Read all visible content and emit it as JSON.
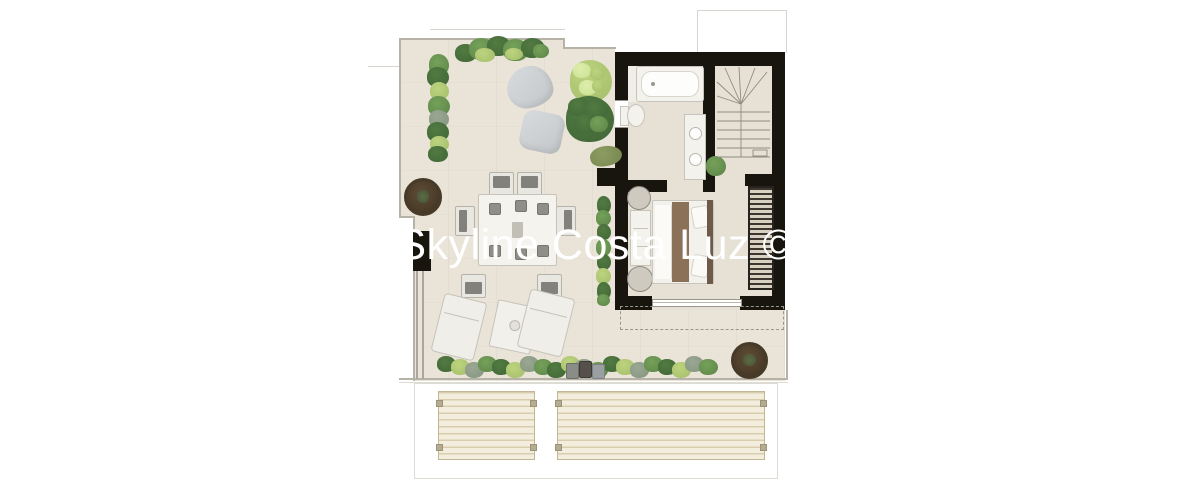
{
  "watermark": {
    "text": "Skyline Costa Luz ©",
    "color": "#ffffff"
  },
  "page": {
    "background": "#ffffff",
    "description": "Top-down rendered architectural floor plan of a penthouse level with wrap-around terrace and pergola canopies"
  },
  "palette": {
    "page-bg": "#ffffff",
    "terrace": "#eae4d8",
    "interior": "#e7e1d5",
    "wall": "#18150f",
    "edge": "#b6b2a8",
    "edge-light": "#dedbd3",
    "furn-white": "#f4f2ed",
    "furn-border": "#c6c3bb",
    "beanbag-a": "#d8dbdd",
    "beanbag-b": "#c3c7ca",
    "g-dark": "#3f6636",
    "g-mid": "#5d8447",
    "g-light": "#a3bd6b",
    "g-lighter": "#cbe092",
    "g-grey": "#84947f",
    "olive": "#75864f",
    "pot": "#5f4c35",
    "pot-dark": "#3f3222",
    "bed-brown": "#8a7158",
    "headboard": "#6e5a48",
    "louver-dark": "#3c362e",
    "louver-light": "#d8d1c2",
    "slat-bg": "#f3edde",
    "slat-line": "#d9cdae",
    "slat-border": "#c4b795",
    "cushion": "#82817b",
    "dash": "#9a968c",
    "stair-line": "#8f8b80",
    "watermark": "#ffffff"
  },
  "plan": {
    "rooms": [
      "terrace",
      "bathroom",
      "staircase",
      "bedroom",
      "pergola-canopies"
    ],
    "objects": [
      "top-hedge",
      "left-planter-strip",
      "two-bean-bags",
      "light-green-tree",
      "dark-green-bush",
      "dining-table-with-six-chairs",
      "round-potted-tree-top",
      "wall-pillar",
      "balustrade",
      "two-sun-loungers",
      "side-table",
      "bottom-hedge",
      "three-small-planters",
      "round-potted-tree-bottom",
      "bathtub",
      "toilet",
      "double-vanity",
      "indoor-plant",
      "winder-staircase",
      "double-bed",
      "wardrobe-column",
      "louvered-closet",
      "sliding-terrace-door",
      "roof-overhang-dashed-line",
      "two-slatted-pergola-panels"
    ]
  }
}
